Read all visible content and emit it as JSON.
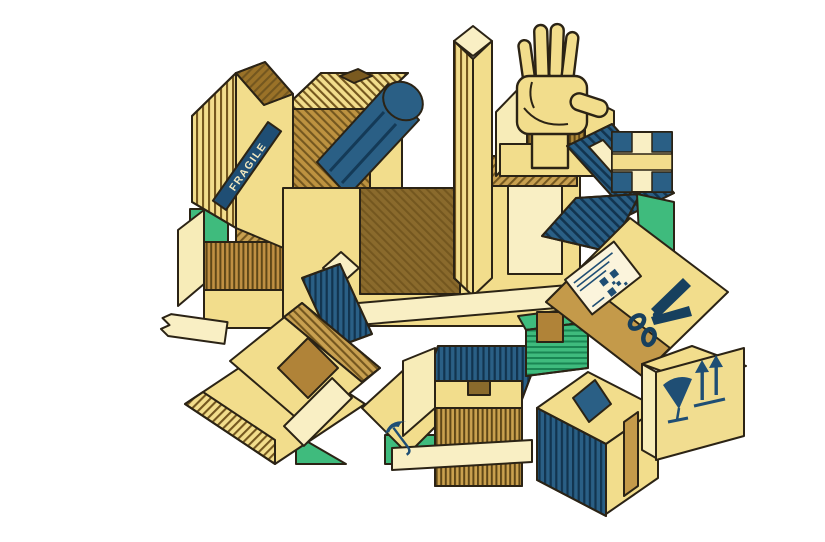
{
  "page": {
    "background_color": "#ffffff",
    "kind": "isometric illustration of stacked cardboard moving boxes"
  },
  "illustration": {
    "fragile_label": "FRAGILE",
    "palette": {
      "yellow": "#F2DD8C",
      "pale_cream": "#F9EFC4",
      "tan": "#C49A4A",
      "kraft_brown": "#8A6A2C",
      "stripe_brown": "#74571F",
      "blue": "#2A5F85",
      "navy": "#1F4E74",
      "stripe_navy": "#12344F",
      "green": "#3FBB7D",
      "outline": "#2B2315"
    },
    "objects": [
      "cardboard-boxes",
      "fragile-tape-band",
      "hand-reaching-from-open-box",
      "blue-poster-tube",
      "packing-tape-strips",
      "checkered-box",
      "shipping-label-with-qr-code",
      "scissors",
      "small-green-box",
      "fragile-wine-glass-symbol",
      "this-side-up-arrows-symbol",
      "keep-dry-umbrella-symbol"
    ]
  }
}
